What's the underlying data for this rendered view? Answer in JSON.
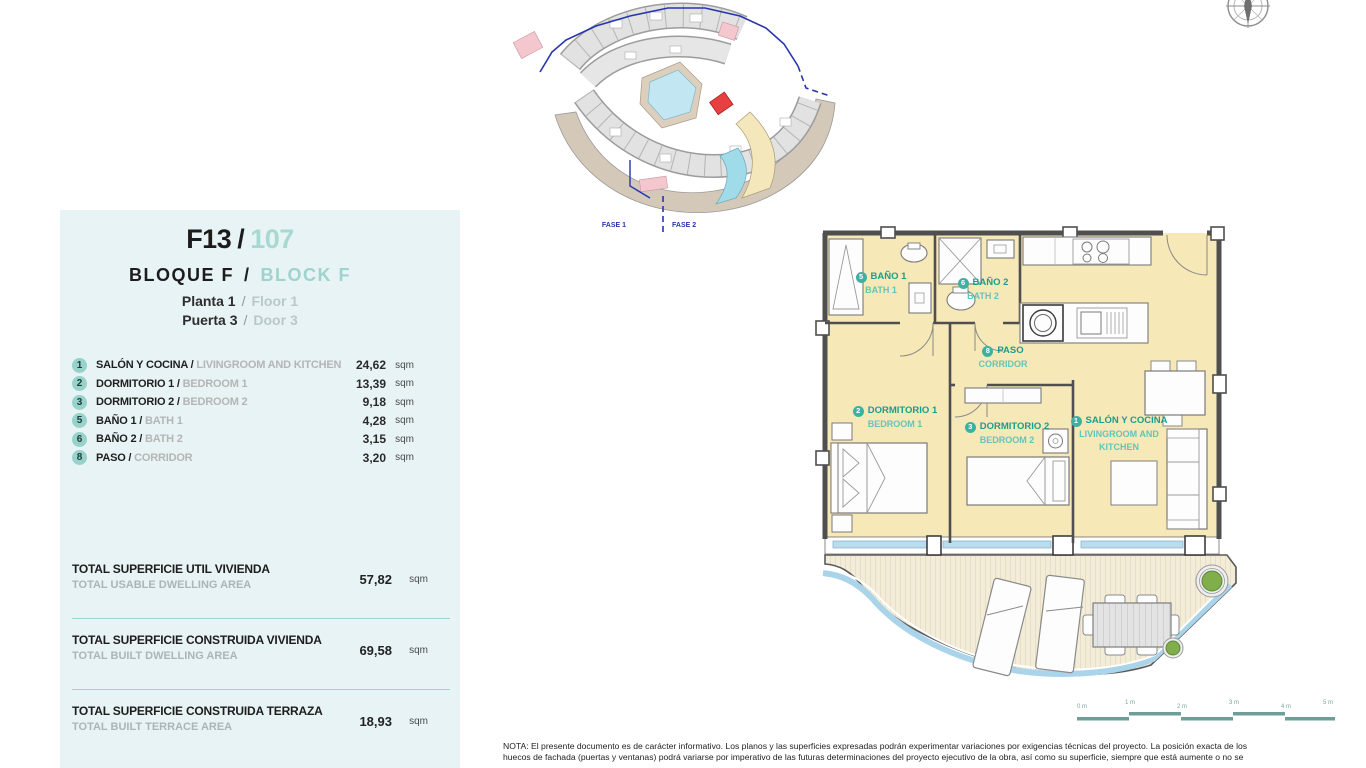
{
  "panel": {
    "title_code": "F13",
    "title_sep": "/",
    "title_number": "107",
    "block_es": "BLOQUE F",
    "block_sep": "/",
    "block_en": "BLOCK F",
    "floor_es": "Planta 1",
    "floor_sep": "/",
    "floor_en": "Floor 1",
    "door_es": "Puerta 3",
    "door_sep": "/",
    "door_en": "Door 3"
  },
  "rooms": [
    {
      "num": "1",
      "es": "SALÓN Y COCINA",
      "sep": " / ",
      "en": "LIVINGROOM AND KITCHEN",
      "area": "24,62",
      "unit": "sqm"
    },
    {
      "num": "2",
      "es": "DORMITORIO 1",
      "sep": " / ",
      "en": "BEDROOM 1",
      "area": "13,39",
      "unit": "sqm"
    },
    {
      "num": "3",
      "es": "DORMITORIO 2",
      "sep": " / ",
      "en": "BEDROOM 2",
      "area": "9,18",
      "unit": "sqm"
    },
    {
      "num": "5",
      "es": "BAÑO 1",
      "sep": " / ",
      "en": "BATH 1",
      "area": "4,28",
      "unit": "sqm"
    },
    {
      "num": "6",
      "es": "BAÑO 2",
      "sep": " / ",
      "en": "BATH 2",
      "area": "3,15",
      "unit": "sqm"
    },
    {
      "num": "8",
      "es": "PASO",
      "sep": " / ",
      "en": "CORRIDOR",
      "area": "3,20",
      "unit": "sqm"
    }
  ],
  "totals": [
    {
      "es": "TOTAL SUPERFICIE UTIL VIVIENDA",
      "en": "TOTAL USABLE DWELLING AREA",
      "value": "57,82",
      "unit": "sqm"
    },
    {
      "es": "TOTAL SUPERFICIE CONSTRUIDA VIVIENDA",
      "en": "TOTAL BUILT DWELLING AREA",
      "value": "69,58",
      "unit": "sqm"
    },
    {
      "es": "TOTAL SUPERFICIE CONSTRUIDA TERRAZA",
      "en": "TOTAL BUILT TERRACE AREA",
      "value": "18,93",
      "unit": "sqm"
    }
  ],
  "siteplan": {
    "fase1": "FASE 1",
    "fase2": "FASE 2"
  },
  "floorplan_labels": {
    "salon": {
      "num": "1",
      "es": "SALÓN Y COCINA",
      "en_line1": "LIVINGROOM AND",
      "en_line2": "KITCHEN"
    },
    "bedroom1": {
      "num": "2",
      "es": "DORMITORIO 1",
      "en": "BEDROOM 1"
    },
    "bedroom2": {
      "num": "3",
      "es": "DORMITORIO 2",
      "en": "BEDROOM 2"
    },
    "bath1": {
      "num": "5",
      "es": "BAÑO 1",
      "en": "BATH 1"
    },
    "bath2": {
      "num": "6",
      "es": "BAÑO 2",
      "en": "BATH 2"
    },
    "paso": {
      "num": "8",
      "es": "PASO",
      "en": "CORRIDOR"
    }
  },
  "scalebar": {
    "labels": [
      "0 m",
      "1 m",
      "2 m",
      "3 m",
      "4 m",
      "5 m"
    ]
  },
  "colors": {
    "panel_bg": "#e8f3f5",
    "accent_teal": "#97d2cb",
    "label_teal_dark": "#1a9d8d",
    "label_teal_light": "#63c5b8",
    "floor": "#f6e8b7",
    "wall": "#4f4f4f",
    "window_glass": "#b9dcee",
    "deck": "#f3ecd8",
    "water_edge": "#aad4ea",
    "planter_green": "#7fae4a",
    "highlight_unit_red": "#e84040",
    "boundary_blue": "#2635ad"
  },
  "note": {
    "line1": "NOTA: El presente documento es de carácter informativo. Los planos y las superficies expresadas podrán experimentar variaciones por exigencias técnicas del proyecto. La posición exacta de los",
    "line2": "huecos de fachada (puertas y ventanas) podrá variarse por imperativo de las futuras determinaciones del proyecto ejecutivo de la obra, así como su superficie, siempre que está aumente o no se"
  }
}
